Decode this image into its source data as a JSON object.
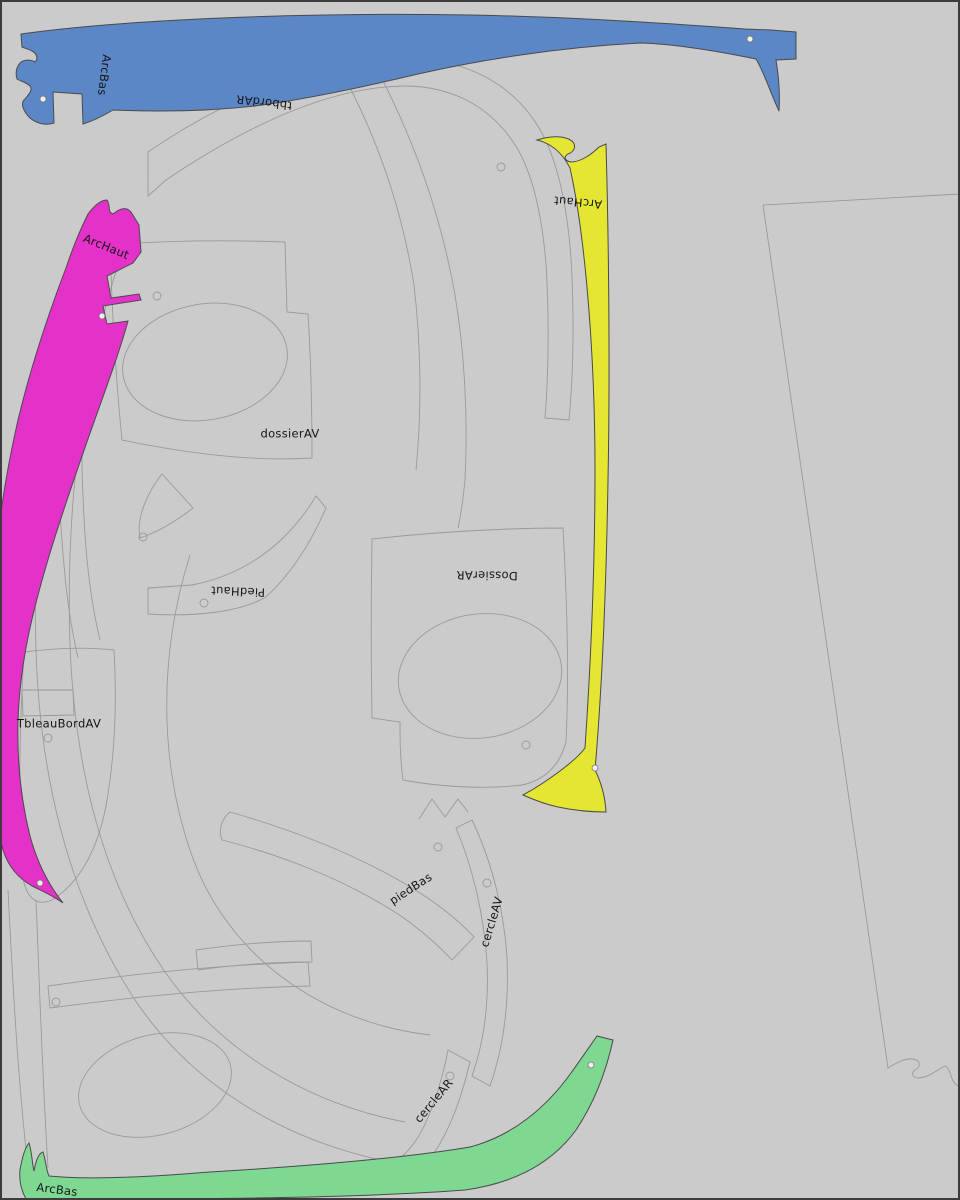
{
  "canvas": {
    "kind": "nesting-layout",
    "background_color": "#cbcbcb",
    "outline_color": "#9a9a9a",
    "border_color": "#3c3c3c"
  },
  "colors": {
    "blue": "#5b87c7",
    "magenta": "#e431c9",
    "yellow": "#e4e632",
    "green": "#7ed892",
    "label_text": "#151515"
  },
  "parts": [
    {
      "label": "ArcBas",
      "fill": "#5b87c7",
      "placement": "top"
    },
    {
      "label": "tbbordAR",
      "fill": "none",
      "placement": "top-center"
    },
    {
      "label": "ArcHaut",
      "fill": "#e431c9",
      "placement": "left"
    },
    {
      "label": "ArcHaut",
      "fill": "#e4e632",
      "placement": "right-center"
    },
    {
      "label": "dossierAV",
      "fill": "none",
      "placement": "upper-middle"
    },
    {
      "label": "PiedHaut",
      "fill": "none",
      "placement": "middle"
    },
    {
      "label": "DossierAR",
      "fill": "none",
      "placement": "center-right"
    },
    {
      "label": "TbleauBordAV",
      "fill": "none",
      "placement": "left-middle"
    },
    {
      "label": "piedBas",
      "fill": "none",
      "placement": "lower-middle"
    },
    {
      "label": "cercleAV",
      "fill": "none",
      "placement": "lower-right"
    },
    {
      "label": "cercleAR",
      "fill": "none",
      "placement": "bottom"
    },
    {
      "label": "ArcBas",
      "fill": "#7ed892",
      "placement": "bottom"
    }
  ]
}
